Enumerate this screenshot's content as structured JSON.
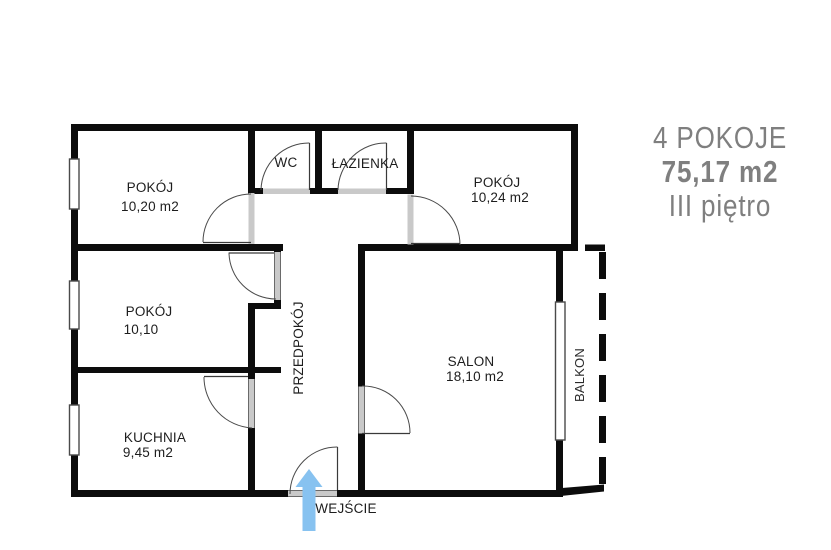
{
  "summary": {
    "rooms_count": "4 POKOJE",
    "area": "75,17 m2",
    "floor": "III piętro"
  },
  "rooms": {
    "pokoj_top_left": {
      "name": "POKÓJ",
      "area": "10,20 m2"
    },
    "wc": {
      "name": "WC"
    },
    "lazienka": {
      "name": "ŁAZIENKA"
    },
    "pokoj_top_right": {
      "name": "POKÓJ",
      "area": "10,24 m2"
    },
    "pokoj_mid_left": {
      "name": "POKÓJ",
      "area": "10,10"
    },
    "przedpokoj": {
      "name": "PRZEDPOKÓJ"
    },
    "salon": {
      "name": "SALON",
      "area": "18,10 m2"
    },
    "kuchnia": {
      "name": "KUCHNIA",
      "area": "9,45 m2"
    },
    "balkon": {
      "name": "BALKON"
    }
  },
  "entrance": {
    "label": "WEJŚCIE"
  },
  "colors": {
    "wall": "#0c0c0c",
    "door_opening": "#c9c9c9",
    "entrance_arrow": "#87c2f0",
    "summary_text": "#7f7f7f",
    "label_text": "#1d1d1d"
  }
}
